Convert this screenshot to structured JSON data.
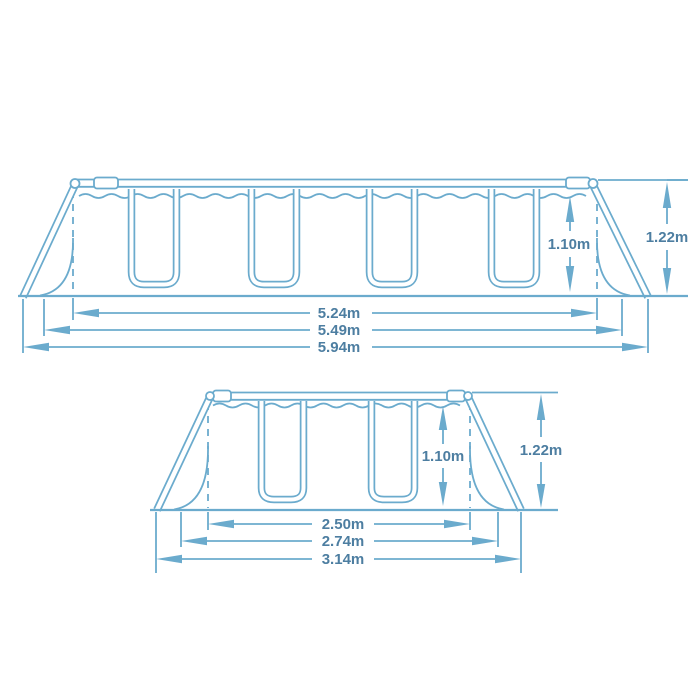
{
  "title": "Frame pool dimensions diagram",
  "colors": {
    "line": "#6babcd",
    "text": "#4d7ea1",
    "background": "#ffffff"
  },
  "diagram_top": {
    "name": "pool long side view",
    "water_depth": {
      "label": "1.10m"
    },
    "total_height": {
      "label": "1.22m"
    },
    "widths": [
      {
        "label": "5.24m"
      },
      {
        "label": "5.49m"
      },
      {
        "label": "5.94m"
      }
    ]
  },
  "diagram_bottom": {
    "name": "pool short side view",
    "water_depth": {
      "label": "1.10m"
    },
    "total_height": {
      "label": "1.22m"
    },
    "widths": [
      {
        "label": "2.50m"
      },
      {
        "label": "2.74m"
      },
      {
        "label": "3.14m"
      }
    ]
  }
}
